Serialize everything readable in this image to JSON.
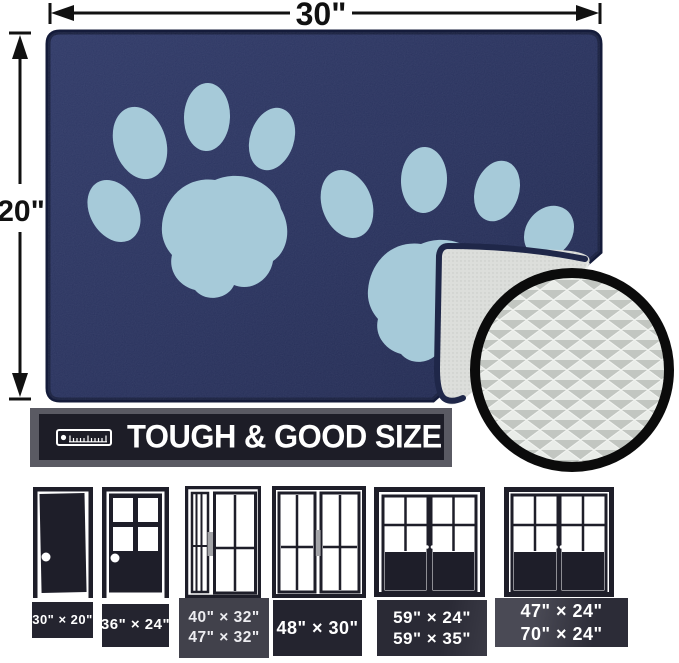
{
  "size_callout": {
    "width": "30\"",
    "height": "20\""
  },
  "banner": {
    "label": "TOUGH & GOOD SIZE"
  },
  "doors": [
    {
      "icon": "solid-door-icon",
      "lines": [
        "30\" × 20\""
      ]
    },
    {
      "icon": "half-glass-door-icon",
      "lines": [
        "36\" × 24\""
      ]
    },
    {
      "icon": "sidelight-door-icon",
      "lines": [
        "40\" × 32\"",
        "47\" × 32\""
      ]
    },
    {
      "icon": "double-glass-door-icon",
      "lines": [
        "48\" × 30\""
      ]
    },
    {
      "icon": "double-french-door-icon",
      "lines": [
        "59\" × 24\"",
        "59\" × 35\""
      ]
    },
    {
      "icon": "wide-double-french-door-icon",
      "lines": [
        "47\" × 24\"",
        "70\" × 24\""
      ]
    }
  ],
  "colors": {
    "mat_navy": "#242e57",
    "mat_edge": "#141b3a",
    "paw_blue": "#a6cad9",
    "backing_gray": "#dcdedb",
    "banner_dark": "#1d1d27",
    "banner_frame_gray": "#5a5a63",
    "label_dark": "#24242f",
    "door_ink": "#1e1e29",
    "ring_black": "#0b0b0b"
  }
}
